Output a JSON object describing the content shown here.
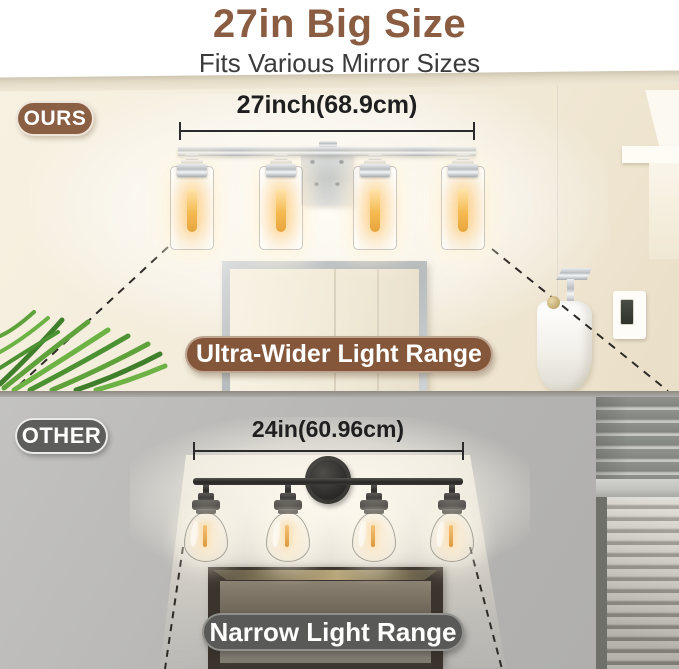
{
  "header": {
    "title": "27in Big Size",
    "subtitle": "Fits Various Mirror Sizes"
  },
  "ours": {
    "badge": "OURS",
    "dimension": "27inch(68.9cm)",
    "feature": "Ultra-Wider Light Range",
    "light_count": 4
  },
  "other": {
    "badge": "OTHER",
    "dimension": "24in(60.96cm)",
    "feature": "Narrow Light Range",
    "light_count": 4
  },
  "colors": {
    "title_brown": "#8a5c42",
    "accent_brown": "#84573a",
    "badge_gray": "#5d5d5b",
    "dimension_text": "#1f1f1f",
    "top_wall": "#f3ecdb",
    "bottom_wall": "#b7b6b4"
  }
}
